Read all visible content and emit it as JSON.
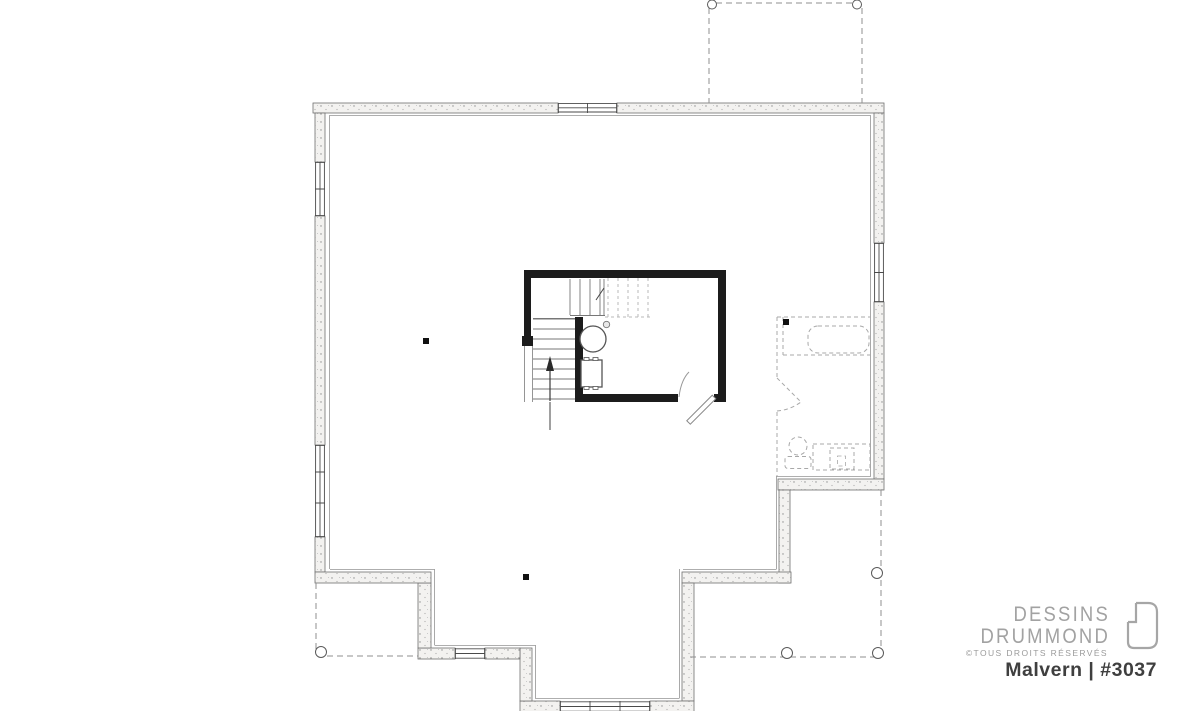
{
  "page": {
    "background": "#ffffff"
  },
  "branding": {
    "name_line1": "DESSINS",
    "name_line2": "DRUMMOND",
    "copyright": "©TOUS DROITS RÉSERVÉS",
    "plan_title": "Malvern | #3037",
    "logo_color": "#a2a2a2",
    "title_color": "#3f3f3f"
  },
  "floor_plan": {
    "type": "basement-foundation-plan",
    "structural_wall_color": "#1c1c1c",
    "foundation_wall_fill": "#f3f2f0",
    "fixtures": [
      "staircase",
      "up-arrow",
      "water-heater",
      "furnace",
      "floor-drain",
      "door-swing",
      "future-bathroom",
      "bathtub",
      "toilet",
      "vanity-sink",
      "support-posts",
      "deck-post-footings"
    ]
  }
}
